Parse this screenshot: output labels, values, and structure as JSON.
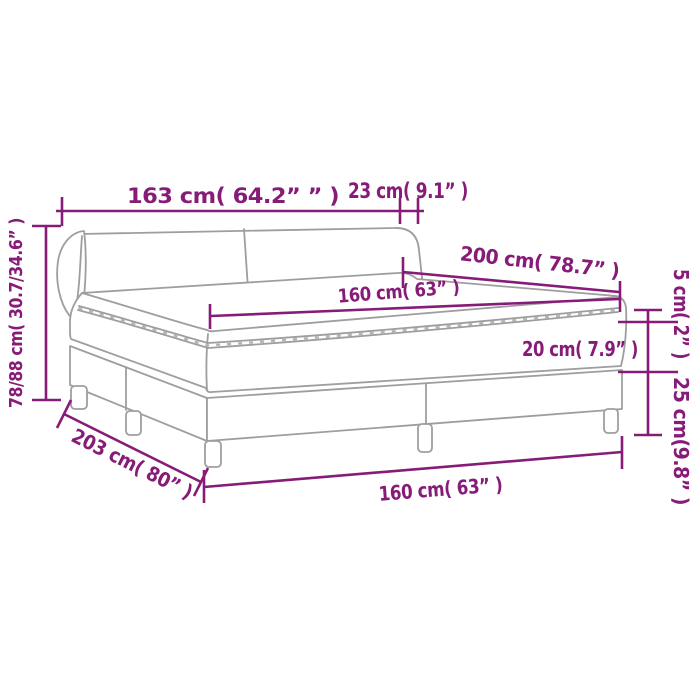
{
  "page": {
    "background_color": "#ffffff"
  },
  "diagram": {
    "subject": "box-spring-bed-dimension-drawing",
    "accent_color": "#871b78",
    "drawing_line_color": "#9e9e9e",
    "labels": {
      "headboard_width": "163 cm( 64.2” ” )",
      "headboard_top_depth": "23 cm( 9.1” )",
      "total_height": "78/88 cm( 30.7/34.6” )",
      "bed_length": "200 cm( 78.7” )",
      "mattress_width": "160 cm( 63” )",
      "mattress_height": "20 cm( 7.9” )",
      "topper_height": "5 cm( 2” )",
      "base_height_with_legs": "25 cm(9.8” )",
      "frame_length": "203 cm( 80” )",
      "base_width": "160 cm( 63” )"
    }
  }
}
